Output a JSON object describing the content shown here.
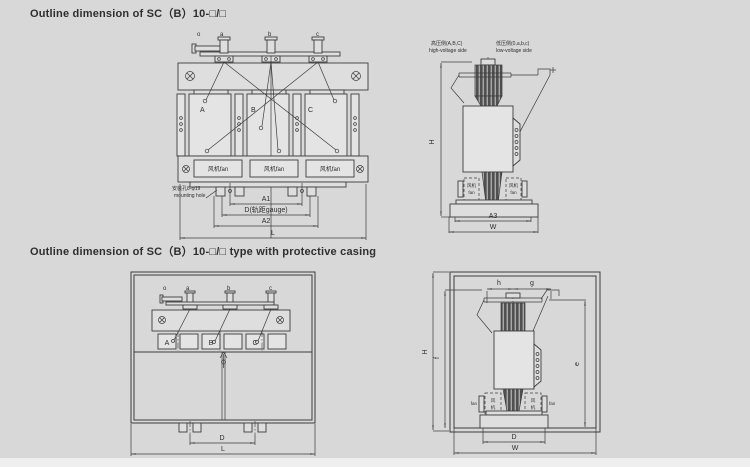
{
  "titles": {
    "top": "Outline dimension of SC（B）10-□/□",
    "bottom": "Outline dimension of SC（B）10-□/□ type with protective casing"
  },
  "front_view": {
    "terminal_o": "o",
    "terminal_a": "a",
    "terminal_b": "b",
    "terminal_c": "c",
    "phase_a": "A",
    "phase_b": "B",
    "phase_c": "C",
    "fan": "风机fan",
    "mounting_hole_cn": "安装孔8-φ19",
    "mounting_hole_en": "mounting hole",
    "dim_a1": "A1",
    "dim_d": "D(轨距gauge)",
    "dim_a2": "A2",
    "dim_l": "L"
  },
  "side_view": {
    "hv_cn": "高压侧(A,B,C)",
    "hv_en": "high-voltage side",
    "lv_cn": "低压侧(0,a,b,c)",
    "lv_en": "low-voltage side",
    "fan_cn": "风机",
    "fan_en": "fan",
    "dim_h": "H",
    "dim_a3": "A3",
    "dim_w": "W"
  },
  "casing_front": {
    "terminal_o": "o",
    "terminal_a": "a",
    "terminal_b": "b",
    "terminal_c": "c",
    "phase_a": "A",
    "phase_b": "B",
    "phase_c": "C",
    "dim_d": "D",
    "dim_l": "L"
  },
  "casing_side": {
    "dim_h": "h",
    "dim_g": "g",
    "dim_H": "H",
    "dim_f": "f",
    "dim_e": "e",
    "fan_cn_1": "风",
    "fan_cn_2": "机",
    "fan_en": "fan",
    "dim_d": "D",
    "dim_w": "W"
  },
  "colors": {
    "background": "#d8d8d8",
    "line": "#3c3c3c",
    "fill_light": "#e4e4e4",
    "coil_dark": "#505050"
  }
}
